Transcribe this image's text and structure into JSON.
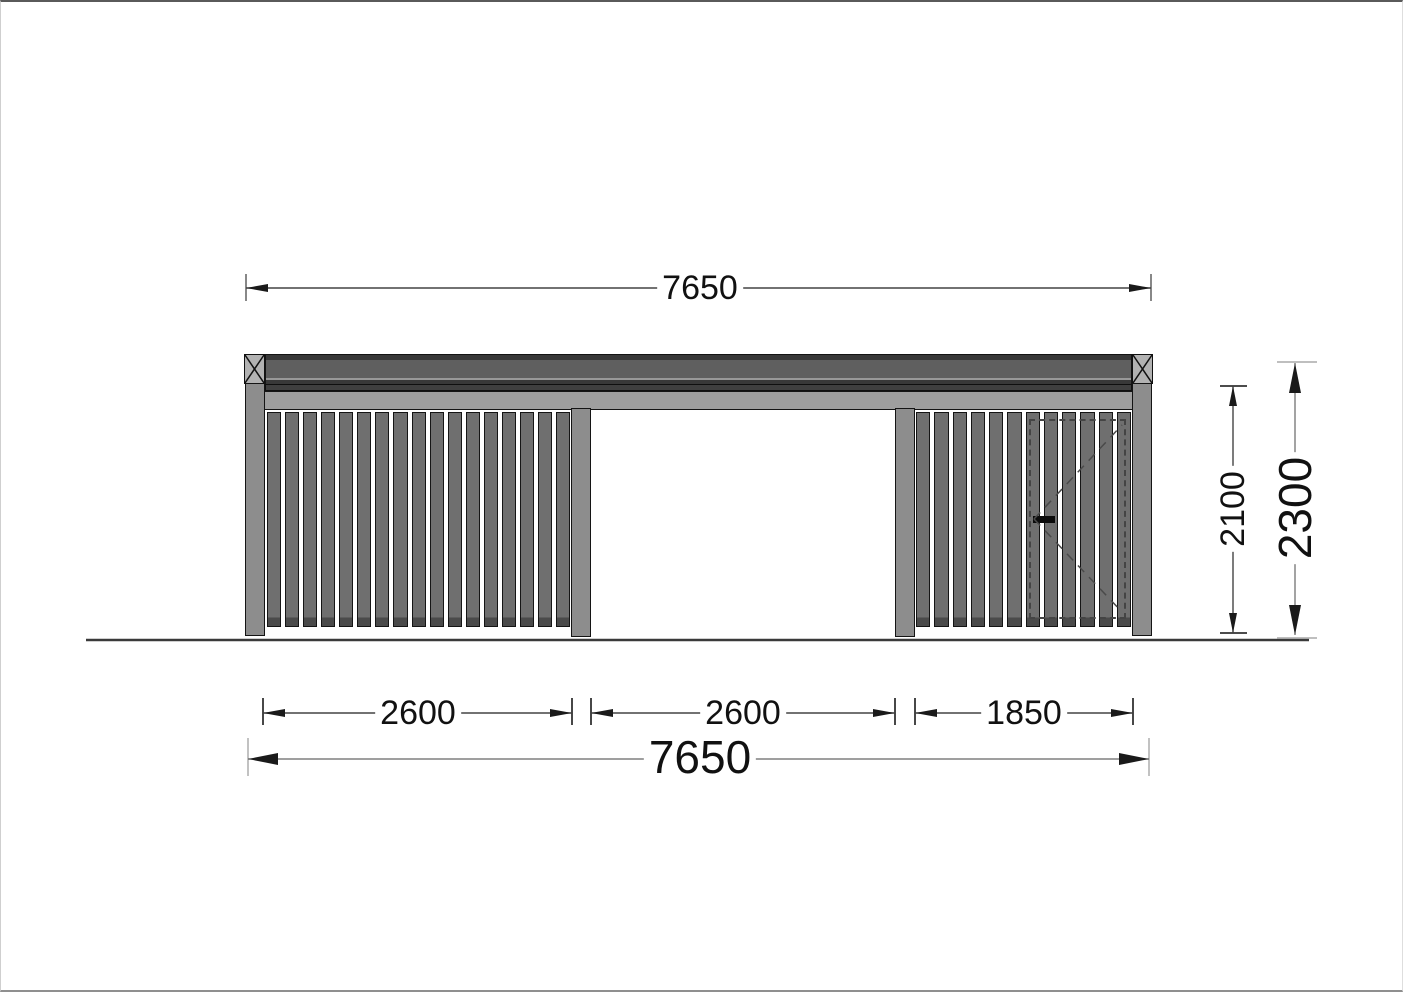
{
  "drawing": {
    "view": "front-elevation",
    "dimensions": {
      "overall_width_top": "7650",
      "bay_left": "2600",
      "bay_middle": "2600",
      "bay_right": "1850",
      "overall_width_bottom": "7650",
      "clear_height": "2100",
      "overall_height": "2300"
    },
    "structure": {
      "left_wall": {
        "slat_count": 17
      },
      "right_wall": {
        "slat_count": 12,
        "has_door": true
      },
      "middle_bay_open": true,
      "post_count": 4
    },
    "colors": {
      "beam": "#5f5f5f",
      "beam_edge": "#383838",
      "fascia": "#9e9e9e",
      "post": "#8d8d8d",
      "slat": "#6f6f6f",
      "cap": "#b2b2b2",
      "dim_line": "#1a1a1a"
    }
  }
}
